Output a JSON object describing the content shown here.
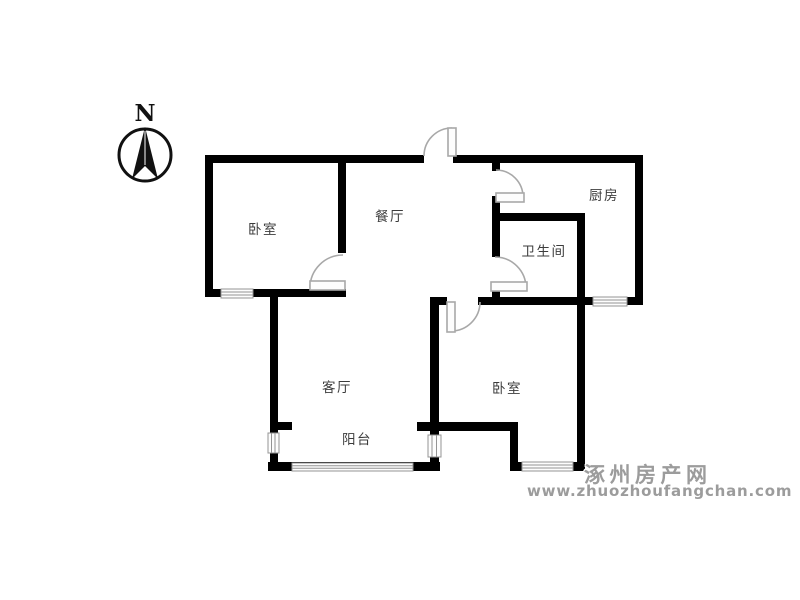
{
  "compass": {
    "label": "N"
  },
  "rooms": {
    "bedroom_top": {
      "label": "卧室"
    },
    "dining": {
      "label": "餐厅"
    },
    "kitchen": {
      "label": "厨房"
    },
    "bathroom": {
      "label": "卫生间"
    },
    "living": {
      "label": "客厅"
    },
    "balcony": {
      "label": "阳台"
    },
    "bedroom_bottom": {
      "label": "卧室"
    }
  },
  "watermark": {
    "site_name": "涿州房产网",
    "site_url": "www.zhuozhoufangchan.com"
  },
  "colors": {
    "wall": "#000000",
    "door": "#a8a8a8",
    "door_leaf_fill": "#fdfdfd",
    "window": "#949494",
    "window_fill": "#fdfdfd",
    "watermark": "#9c9c9c",
    "background": "#ffffff",
    "label_text": "#3c3c3c"
  }
}
